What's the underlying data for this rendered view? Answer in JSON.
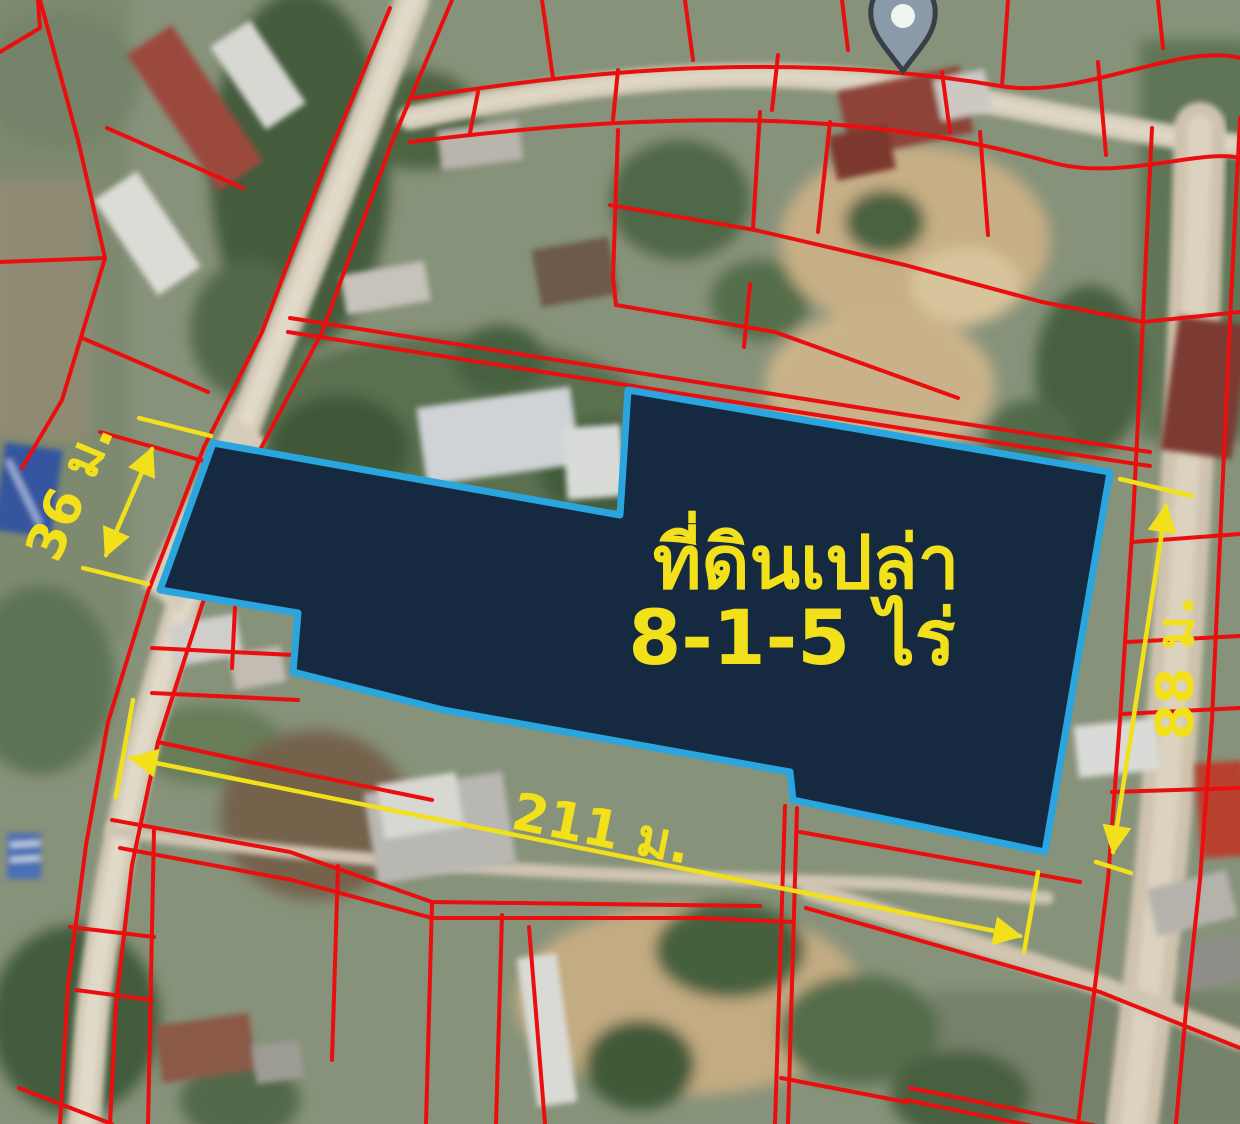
{
  "map": {
    "parcel": {
      "title": "ที่ดินเปล่า",
      "area": "8-1-5 ไร่",
      "fill_color": "#152a41",
      "border_color": "#2aa5dd"
    },
    "dimensions": {
      "west": "36 ม.",
      "south": "211 ม.",
      "east": "88 ม.",
      "color": "#f2e11a"
    },
    "cadastral": {
      "line_color": "#ea0e0e"
    },
    "icons": {
      "pin": "map-pin-icon"
    }
  }
}
